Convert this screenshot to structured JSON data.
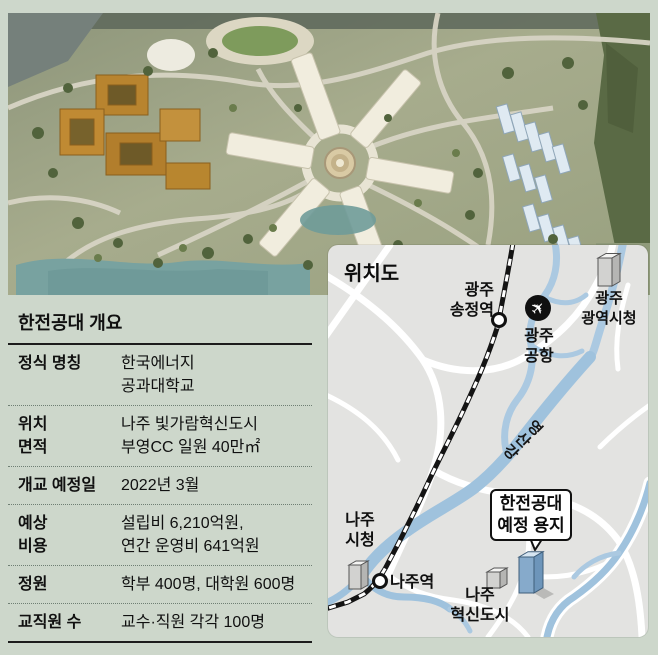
{
  "page_bg": "#cdd7cb",
  "overview": {
    "title": "한전공대 개요",
    "rows": [
      {
        "label": "정식 명칭",
        "value": "한국에너지\n공과대학교"
      },
      {
        "label": "위치\n면적",
        "value": "나주 빛가람혁신도시\n부영CC 일원 40만㎡"
      },
      {
        "label": "개교 예정일",
        "value": "2022년 3월"
      },
      {
        "label": "예상\n비용",
        "value": "설립비 6,210억원,\n연간 운영비 641억원"
      },
      {
        "label": "정원",
        "value": "학부 400명, 대학원 600명"
      },
      {
        "label": "교직원 수",
        "value": "교수·직원 각각 100명"
      }
    ]
  },
  "map": {
    "title": "위치도",
    "labels": {
      "songjeong": "광주\n송정역",
      "airport": "광주\n공항",
      "gwangju_cityhall": "광주\n광역시청",
      "river": "영산강",
      "naju_cityhall": "나주\n시청",
      "naju_station": "나주역",
      "innovation_city": "나주\n혁신도시",
      "callout": "한전공대\n예정 용지"
    },
    "icons": {
      "airplane": "✈",
      "airport_icon_name": "airplane-in-black-circle",
      "station_icon_name": "white-circle-station-marker",
      "building_icon_name": "isometric-building"
    },
    "colors": {
      "panel_bg": "#e3e3e1",
      "road": "#ffffff",
      "river": "#a9c9e1",
      "railway": "#141414",
      "site_building_blue": "#86aacb",
      "gray_building": "#d2d2d0"
    }
  }
}
